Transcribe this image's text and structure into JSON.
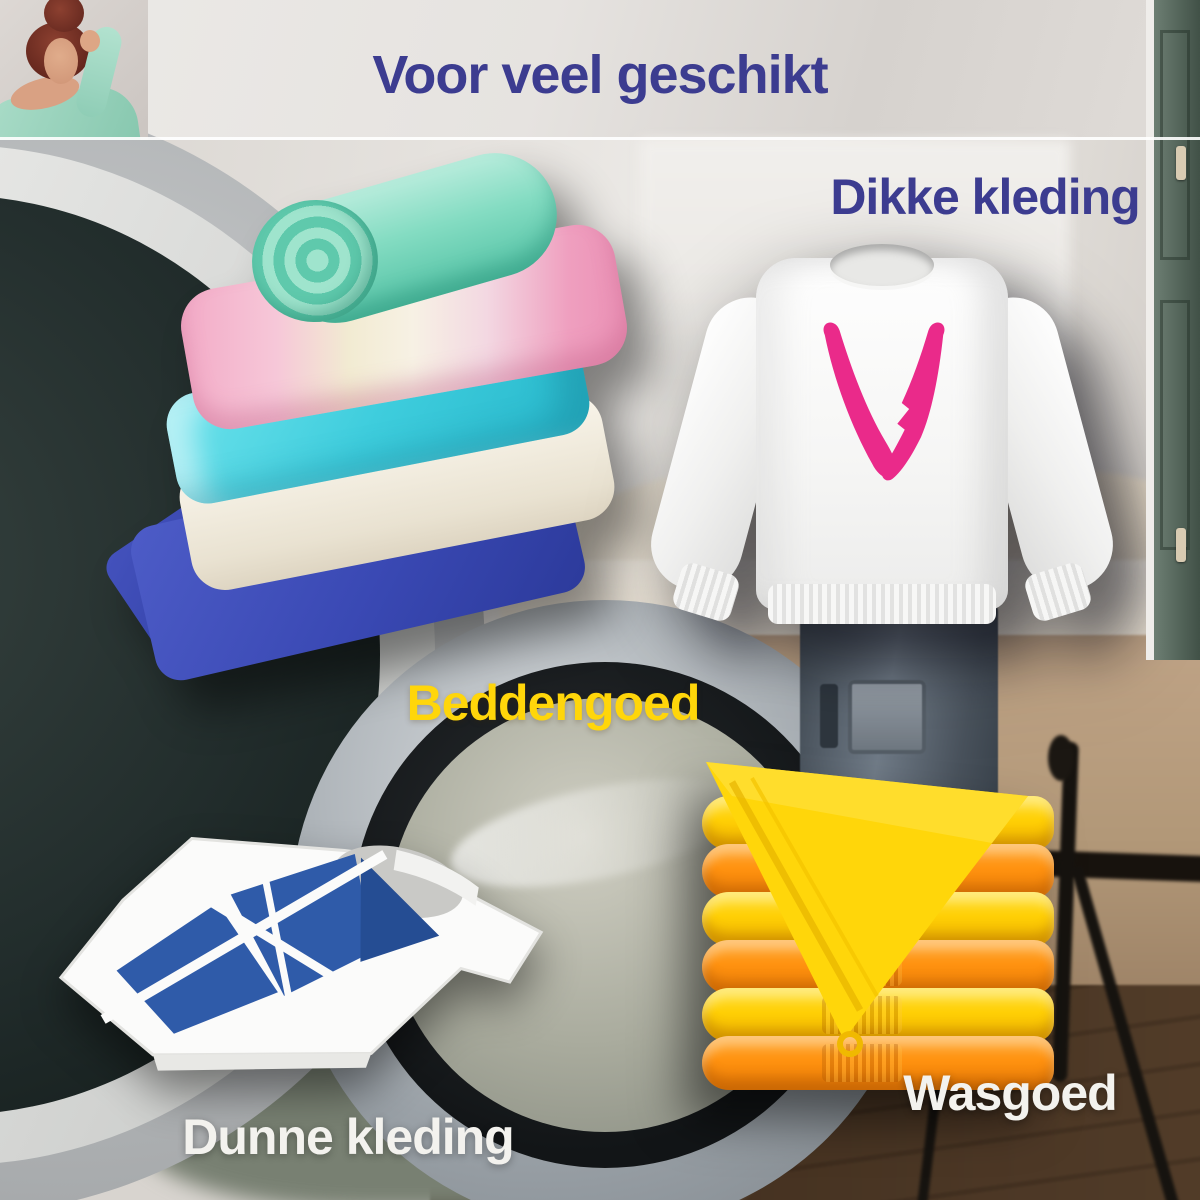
{
  "poster": {
    "title": "Voor veel geschikt",
    "labels": {
      "dikke": "Dikke kleding",
      "beddengoed": "Beddengoed",
      "dunne": "Dunne kleding",
      "wasgoed": "Wasgoed"
    },
    "colors": {
      "heading": "#3c3c90",
      "yellow_label": "#ffd60a",
      "light_label": "#f3f2ee",
      "sweater_logo_pink": "#ea2a8a",
      "tshirt_logo_blue": "#2f5ba9",
      "towel_yellow": "#ffcf05",
      "towel_orange": "#ff9210"
    }
  }
}
